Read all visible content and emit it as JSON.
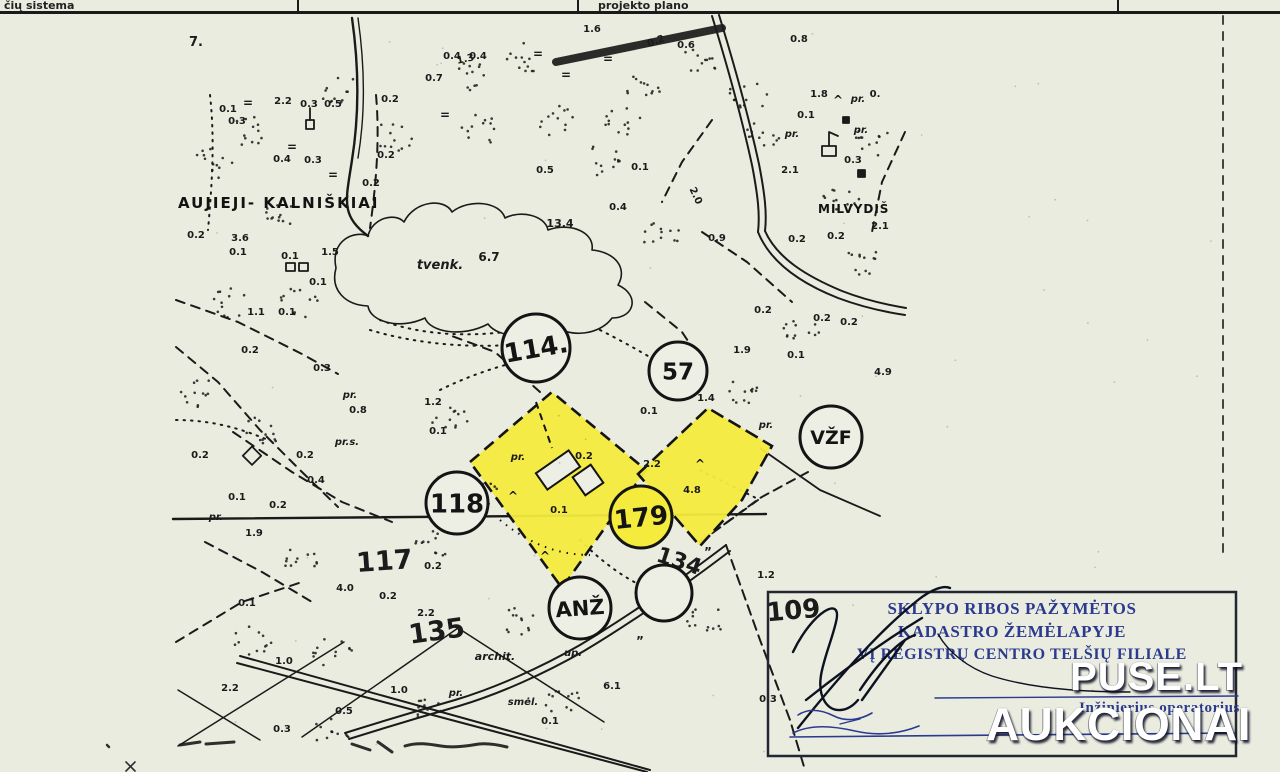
{
  "header": {
    "left_fragment": "čių sistema",
    "right_fragment": "projekto plano"
  },
  "colors": {
    "paper": "#edefe4",
    "ink": "#1a1a1a",
    "highlight": "#f4eb3d",
    "stamp_blue": "#2b3a8f"
  },
  "map": {
    "place_names": [
      {
        "t": "AUJIEJI- KALNIŠKIAI",
        "x": 178,
        "y": 208,
        "fs": 15,
        "ls": 2
      },
      {
        "t": "MILVYDIŠ",
        "x": 818,
        "y": 213,
        "fs": 12,
        "ls": 1
      }
    ],
    "plot_circles": [
      {
        "label": "",
        "x": 664,
        "y": 593,
        "r": 28,
        "fs": 20,
        "rot": 0,
        "fill": "#edefe4"
      },
      {
        "label": "114.",
        "x": 536,
        "y": 348,
        "r": 34,
        "fs": 26,
        "rot": -10,
        "fill": "#edefe4"
      },
      {
        "label": "57",
        "x": 678,
        "y": 371,
        "r": 29,
        "fs": 23,
        "rot": 0,
        "fill": "#edefe4"
      },
      {
        "label": "118",
        "x": 457,
        "y": 503,
        "r": 31,
        "fs": 26,
        "rot": 0,
        "fill": "#edefe4"
      },
      {
        "label": "179",
        "x": 641,
        "y": 517,
        "r": 31,
        "fs": 26,
        "rot": -6,
        "fill": "#f4eb3d"
      },
      {
        "label": "VŽF",
        "x": 831,
        "y": 437,
        "r": 31,
        "fs": 19,
        "rot": 0,
        "fill": "#edefe4"
      },
      {
        "label": "ANŽ",
        "x": 580,
        "y": 608,
        "r": 31,
        "fs": 21,
        "rot": -4,
        "fill": "#edefe4"
      }
    ],
    "labels": [
      {
        "t": "7.",
        "x": 196,
        "y": 46,
        "fs": 13
      },
      {
        "t": "1.6",
        "x": 592,
        "y": 32
      },
      {
        "t": "0.2",
        "x": 657,
        "y": 44,
        "rot": -20
      },
      {
        "t": "0.6",
        "x": 686,
        "y": 48
      },
      {
        "t": "0.8",
        "x": 799,
        "y": 42
      },
      {
        "t": "1.8",
        "x": 819,
        "y": 97
      },
      {
        "t": "pr.",
        "x": 858,
        "y": 102,
        "it": 1
      },
      {
        "t": "0.",
        "x": 875,
        "y": 97
      },
      {
        "t": "0.1",
        "x": 806,
        "y": 118
      },
      {
        "t": "pr.",
        "x": 792,
        "y": 137,
        "it": 1
      },
      {
        "t": "pr.",
        "x": 861,
        "y": 133,
        "it": 1
      },
      {
        "t": "0.3",
        "x": 853,
        "y": 163
      },
      {
        "t": "2.1",
        "x": 790,
        "y": 173
      },
      {
        "t": "2.2",
        "x": 283,
        "y": 104
      },
      {
        "t": "0.3",
        "x": 309,
        "y": 107
      },
      {
        "t": "0.5",
        "x": 333,
        "y": 107
      },
      {
        "t": "0.2",
        "x": 390,
        "y": 102
      },
      {
        "t": "0.7",
        "x": 434,
        "y": 81
      },
      {
        "t": "0.4",
        "x": 452,
        "y": 59
      },
      {
        "t": "0.4",
        "x": 478,
        "y": 59
      },
      {
        "t": "0.3",
        "x": 237,
        "y": 124
      },
      {
        "t": "0.1",
        "x": 228,
        "y": 112
      },
      {
        "t": "1.3",
        "x": 466,
        "y": 62,
        "rot": -12
      },
      {
        "t": "0.4",
        "x": 282,
        "y": 162
      },
      {
        "t": "0.3",
        "x": 313,
        "y": 163
      },
      {
        "t": "0.2",
        "x": 386,
        "y": 158
      },
      {
        "t": "0.2",
        "x": 371,
        "y": 186
      },
      {
        "t": "0.5",
        "x": 545,
        "y": 173
      },
      {
        "t": "0.1",
        "x": 640,
        "y": 170
      },
      {
        "t": "0.4",
        "x": 618,
        "y": 210
      },
      {
        "t": "2.0",
        "x": 693,
        "y": 197,
        "rot": 65
      },
      {
        "t": "13.4",
        "x": 560,
        "y": 227,
        "fs": 11
      },
      {
        "t": "0.9",
        "x": 717,
        "y": 241
      },
      {
        "t": "0.2",
        "x": 797,
        "y": 242
      },
      {
        "t": "0.2",
        "x": 836,
        "y": 239
      },
      {
        "t": "2.1",
        "x": 880,
        "y": 229
      },
      {
        "t": "3.6",
        "x": 240,
        "y": 241
      },
      {
        "t": "0.2",
        "x": 196,
        "y": 238
      },
      {
        "t": "0.1",
        "x": 238,
        "y": 255
      },
      {
        "t": "0.1",
        "x": 290,
        "y": 259
      },
      {
        "t": "1.5",
        "x": 330,
        "y": 255
      },
      {
        "t": "0.1",
        "x": 318,
        "y": 285
      },
      {
        "t": "tvenk.",
        "x": 440,
        "y": 269,
        "it": 1,
        "fs": 13
      },
      {
        "t": "6.7",
        "x": 489,
        "y": 261,
        "fs": 12
      },
      {
        "t": "1.1",
        "x": 256,
        "y": 315
      },
      {
        "t": "0.1",
        "x": 287,
        "y": 315
      },
      {
        "t": "0.2",
        "x": 250,
        "y": 353
      },
      {
        "t": "0.3",
        "x": 322,
        "y": 371
      },
      {
        "t": "pr.",
        "x": 350,
        "y": 398,
        "it": 1
      },
      {
        "t": "0.8",
        "x": 358,
        "y": 413
      },
      {
        "t": "pr.s.",
        "x": 347,
        "y": 445,
        "it": 1
      },
      {
        "t": "0.2",
        "x": 200,
        "y": 458
      },
      {
        "t": "0.2",
        "x": 305,
        "y": 458
      },
      {
        "t": "0.4",
        "x": 316,
        "y": 483
      },
      {
        "t": "0.1",
        "x": 237,
        "y": 500
      },
      {
        "t": "0.2",
        "x": 278,
        "y": 508
      },
      {
        "t": "pr.",
        "x": 216,
        "y": 520,
        "it": 1
      },
      {
        "t": "1.9",
        "x": 254,
        "y": 536
      },
      {
        "t": "0.2",
        "x": 763,
        "y": 313
      },
      {
        "t": "0.2",
        "x": 822,
        "y": 321
      },
      {
        "t": "0.2",
        "x": 849,
        "y": 325
      },
      {
        "t": "1.9",
        "x": 742,
        "y": 353
      },
      {
        "t": "0.1",
        "x": 796,
        "y": 358
      },
      {
        "t": "4.9",
        "x": 883,
        "y": 375
      },
      {
        "t": "pr.",
        "x": 766,
        "y": 428,
        "it": 1
      },
      {
        "t": "0.1",
        "x": 649,
        "y": 414
      },
      {
        "t": "1.4",
        "x": 706,
        "y": 401
      },
      {
        "t": "1.2",
        "x": 433,
        "y": 405
      },
      {
        "t": "0.1",
        "x": 438,
        "y": 434
      },
      {
        "t": "pr.",
        "x": 518,
        "y": 460,
        "it": 1
      },
      {
        "t": "0.2",
        "x": 584,
        "y": 459
      },
      {
        "t": "0.1",
        "x": 559,
        "y": 513
      },
      {
        "t": "2.2",
        "x": 652,
        "y": 467
      },
      {
        "t": "4.8",
        "x": 692,
        "y": 493
      },
      {
        "t": "117",
        "x": 385,
        "y": 570,
        "fs": 27,
        "rot": -4
      },
      {
        "t": "0.2",
        "x": 433,
        "y": 569
      },
      {
        "t": "0.2",
        "x": 388,
        "y": 599
      },
      {
        "t": "2.2",
        "x": 426,
        "y": 616
      },
      {
        "t": "135",
        "x": 438,
        "y": 640,
        "fs": 27,
        "rot": -8
      },
      {
        "t": "4.0",
        "x": 345,
        "y": 591
      },
      {
        "t": "0.1",
        "x": 247,
        "y": 606
      },
      {
        "t": "134",
        "x": 677,
        "y": 568,
        "fs": 22,
        "rot": 18
      },
      {
        "t": "1.2",
        "x": 766,
        "y": 578
      },
      {
        "t": "1.0",
        "x": 284,
        "y": 664
      },
      {
        "t": "2.2",
        "x": 230,
        "y": 691
      },
      {
        "t": "0.5",
        "x": 344,
        "y": 714
      },
      {
        "t": "0.3",
        "x": 282,
        "y": 732
      },
      {
        "t": "1.0",
        "x": 399,
        "y": 693
      },
      {
        "t": "pr.",
        "x": 456,
        "y": 696,
        "it": 1
      },
      {
        "t": "archit.",
        "x": 495,
        "y": 660,
        "it": 1,
        "fs": 11
      },
      {
        "t": "smėl.",
        "x": 523,
        "y": 705,
        "it": 1
      },
      {
        "t": "0.1",
        "x": 550,
        "y": 724
      },
      {
        "t": "up.",
        "x": 573,
        "y": 656,
        "it": 1
      },
      {
        "t": "6.1",
        "x": 612,
        "y": 689
      },
      {
        "t": "109",
        "x": 794,
        "y": 619,
        "fs": 26,
        "rot": -5
      },
      {
        "t": "0.3",
        "x": 768,
        "y": 702
      },
      {
        "t": "=",
        "x": 248,
        "y": 107,
        "fs": 12
      },
      {
        "t": "=",
        "x": 292,
        "y": 151,
        "fs": 12
      },
      {
        "t": "=",
        "x": 538,
        "y": 58,
        "fs": 12
      },
      {
        "t": "=",
        "x": 566,
        "y": 79,
        "fs": 12
      },
      {
        "t": "=",
        "x": 608,
        "y": 63,
        "fs": 12
      },
      {
        "t": "=",
        "x": 445,
        "y": 119,
        "fs": 12
      },
      {
        "t": "=",
        "x": 333,
        "y": 179,
        "fs": 12
      },
      {
        "t": "=",
        "x": 520,
        "y": 333,
        "fs": 12
      },
      {
        "t": "^",
        "x": 513,
        "y": 500,
        "fs": 12
      },
      {
        "t": "^",
        "x": 545,
        "y": 560,
        "fs": 12
      },
      {
        "t": "^",
        "x": 838,
        "y": 104,
        "fs": 12
      },
      {
        "t": "^",
        "x": 700,
        "y": 468,
        "fs": 12
      },
      {
        "t": "”",
        "x": 640,
        "y": 645,
        "fs": 12
      },
      {
        "t": "”",
        "x": 708,
        "y": 556,
        "fs": 12
      }
    ]
  },
  "stamp": {
    "line1": "SKLYPO RIBOS PAŽYMĖTOS",
    "line2": "KADASTRO ŽEMĖLAPYJE",
    "line3": "VĮ REGISTRŲ CENTRO TELŠIŲ FILIALE",
    "role": "Inžinierius operatorius"
  },
  "watermark": {
    "line1": "PUSE.LT",
    "line2": "AUKCIONAI"
  }
}
